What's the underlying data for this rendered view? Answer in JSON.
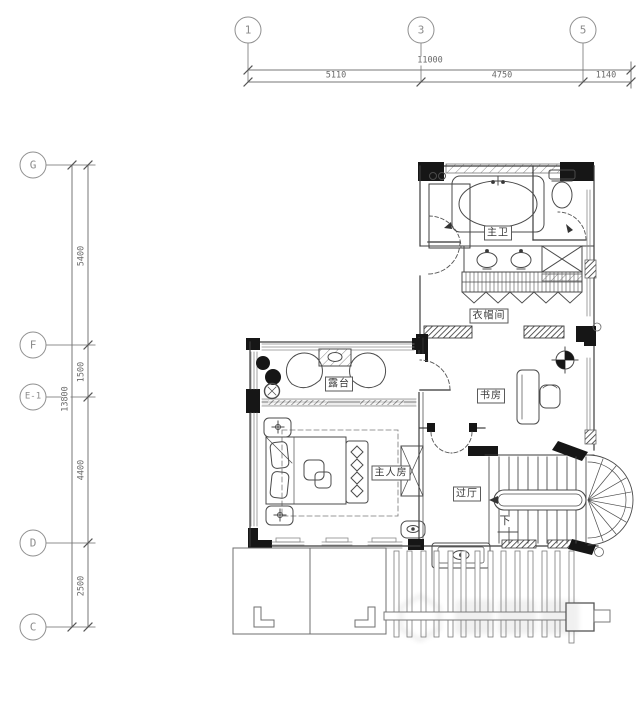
{
  "drawing": {
    "grid": {
      "top_axes": [
        "1",
        "3",
        "5"
      ],
      "left_axes": [
        "G",
        "F",
        "E-1",
        "D",
        "C"
      ],
      "top_dims": {
        "total": "11000",
        "segments": [
          "5110",
          "4750",
          "1140"
        ]
      },
      "left_dims": {
        "total": "13800",
        "segments": [
          "5400",
          "1500",
          "4400",
          "2500"
        ]
      }
    },
    "rooms": {
      "master_bath": "主卫",
      "cloakroom": "衣帽间",
      "study": "书房",
      "terrace": "露台",
      "master_bedroom": "主人房",
      "hall": "过厅"
    },
    "annotations": {
      "stairs_down": "下"
    },
    "colors": {
      "line": "#4b4b4b",
      "wall_fill": "#161616",
      "dim_text": "#6a6a6a",
      "label_text": "#3a3a3a"
    }
  }
}
